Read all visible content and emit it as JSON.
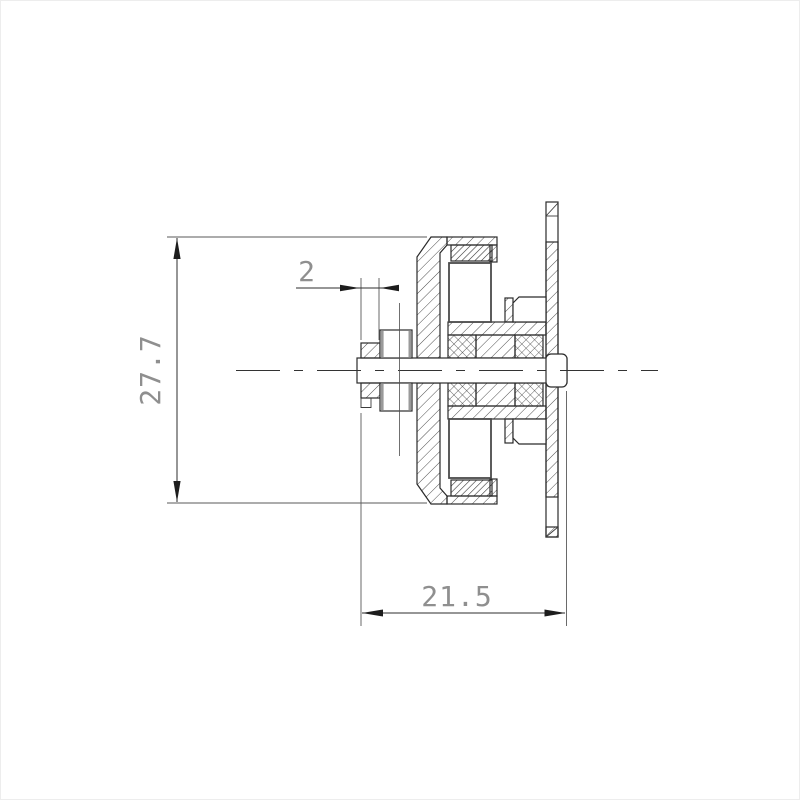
{
  "drawing": {
    "kind": "engineering-cross-section",
    "dimensions": {
      "motor_diameter": {
        "label": "27.7"
      },
      "collar_width": {
        "label": "2"
      },
      "motor_length": {
        "label": "21.5"
      }
    },
    "colors": {
      "background": "#ffffff",
      "line": "#2b2b2b",
      "hatch": "#3a3a3a",
      "dim_text": "#8f8f8f"
    }
  }
}
